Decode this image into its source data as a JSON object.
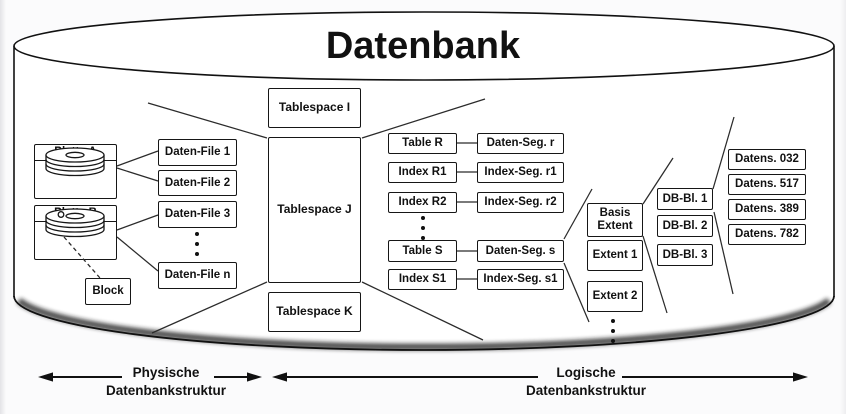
{
  "title": "Datenbank",
  "physical": {
    "platte_a": "Platte A",
    "platte_b": "Platte B",
    "block": "Block",
    "daten_files": [
      "Daten-File 1",
      "Daten-File 2",
      "Daten-File 3",
      "Daten-File n"
    ]
  },
  "tablespaces": [
    "Tablespace I",
    "Tablespace J",
    "Tablespace K"
  ],
  "tables": [
    "Table R",
    "Index R1",
    "Index R2",
    "Table S",
    "Index S1"
  ],
  "segments": [
    "Daten-Seg. r",
    "Index-Seg. r1",
    "Index-Seg. r2",
    "Daten-Seg. s",
    "Index-Seg. s1"
  ],
  "extents": [
    "Basis Extent",
    "Extent 1",
    "Extent 2"
  ],
  "db_blocks": [
    "DB-Bl. 1",
    "DB-Bl. 2",
    "DB-Bl. 3"
  ],
  "datensaetze": [
    "Datens. 032",
    "Datens. 517",
    "Datens. 389",
    "Datens. 782"
  ],
  "legend": {
    "physical": {
      "line1": "Physische",
      "line2": "Datenbankstruktur"
    },
    "logical": {
      "line1": "Logische",
      "line2": "Datenbankstruktur"
    }
  },
  "colors": {
    "line": "#1c1c1c",
    "box_bg": "#ffffff",
    "page_bg": "#fbfbfc"
  }
}
